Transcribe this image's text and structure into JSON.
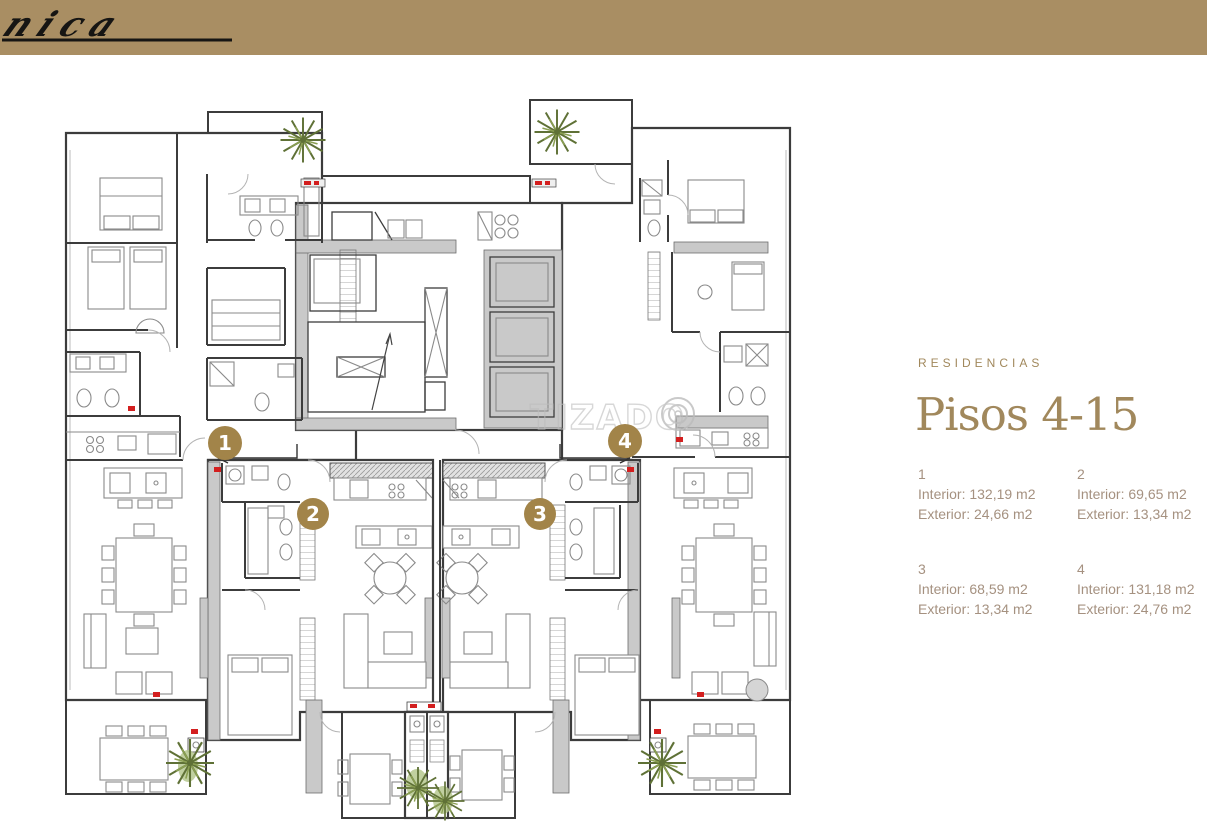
{
  "brand": {
    "logo_text": "unica",
    "band_color": "#a98e63"
  },
  "panel": {
    "eyebrow": "RESIDENCIAS",
    "title": "Pisos 4-15",
    "units": [
      {
        "number": "1",
        "interior": "Interior: 132,19 m2",
        "exterior": "Exterior: 24,66 m2"
      },
      {
        "number": "2",
        "interior": "Interior: 69,65 m2",
        "exterior": "Exterior: 13,34 m2"
      },
      {
        "number": "3",
        "interior": "Interior: 68,59 m2",
        "exterior": "Exterior: 13,34 m2"
      },
      {
        "number": "4",
        "interior": "Interior: 131,18 m2",
        "exterior": "Exterior: 24,76 m2"
      }
    ]
  },
  "plan": {
    "watermark": "TIZADO",
    "markers": [
      {
        "label": "1"
      },
      {
        "label": "2"
      },
      {
        "label": "3"
      },
      {
        "label": "4"
      }
    ]
  },
  "colors": {
    "band": "#a98e63",
    "gold_text": "#a1885c",
    "marker_gold": "#a28449",
    "muted_text": "#a59180",
    "wall": "#3c3c3c",
    "poche_gray": "#c9c9c9",
    "accent_red": "#d31f1f",
    "palm_green": "#5f7136"
  }
}
